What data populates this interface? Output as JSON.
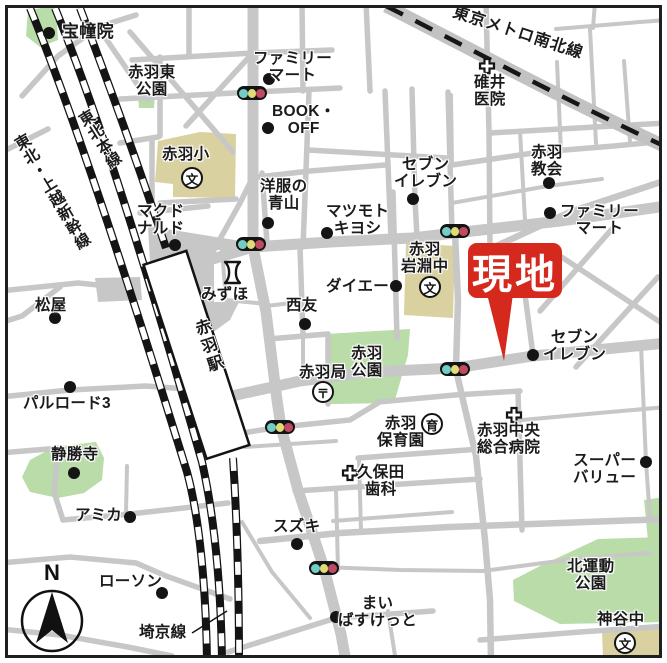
{
  "colors": {
    "road": "#c7c7c7",
    "park": "#b9dca8",
    "building": "#d9d1a0",
    "rail_black": "#141414",
    "target_red": "#d6291d",
    "text": "#1b1b1b",
    "signal_left": "#72cdc6",
    "signal_middle": "#dfdc76",
    "signal_right": "#c14a63"
  },
  "target": {
    "label": "現地"
  },
  "compass": {
    "label": "N"
  },
  "icons": {
    "school": "文",
    "post_office": "〒",
    "nursery": "育"
  },
  "railways": {
    "tohoku_honsen": "東北本線",
    "shinkansen": "東北・上越新幹線",
    "saikyo": "埼京線",
    "namboku": "東京メトロ南北線",
    "station": "赤羽駅"
  },
  "places": [
    {
      "id": "houdouin",
      "label": "宝幢院"
    },
    {
      "id": "akabane-higashi-park",
      "label": "赤羽東\n公園"
    },
    {
      "id": "familymart-north",
      "label": "ファミリー\nマート"
    },
    {
      "id": "book-off",
      "label": "BOOK・\nOFF"
    },
    {
      "id": "usui-clinic",
      "label": "碓井\n医院"
    },
    {
      "id": "akabane-elementary",
      "label": "赤羽小"
    },
    {
      "id": "seven-eleven-north",
      "label": "セブン\nイレブン"
    },
    {
      "id": "akabane-church",
      "label": "赤羽\n教会"
    },
    {
      "id": "yofuku-no-aoyama",
      "label": "洋服の\n青山"
    },
    {
      "id": "mcdonalds",
      "label": "マクド\nナルド"
    },
    {
      "id": "matsumoto-kiyoshi",
      "label": "マツモト\nキヨシ"
    },
    {
      "id": "familymart-east",
      "label": "ファミリー\nマート"
    },
    {
      "id": "akabane-iwabuchi-jhs",
      "label": "赤羽\n岩淵中"
    },
    {
      "id": "mizuho",
      "label": "みずほ"
    },
    {
      "id": "daiei",
      "label": "ダイエー"
    },
    {
      "id": "seiyu",
      "label": "西友"
    },
    {
      "id": "matsuya",
      "label": "松屋"
    },
    {
      "id": "akabane-park",
      "label": "赤羽\n公園"
    },
    {
      "id": "akabane-post-office",
      "label": "赤羽局"
    },
    {
      "id": "palroad3",
      "label": "パルロード3"
    },
    {
      "id": "seven-eleven-east",
      "label": "セブン\nイレブン"
    },
    {
      "id": "akabane-nursery",
      "label": "赤羽\n保育園"
    },
    {
      "id": "akabane-chuo-hospital",
      "label": "赤羽中央\n総合病院"
    },
    {
      "id": "super-value",
      "label": "スーパー\nバリュー"
    },
    {
      "id": "kubota-dental",
      "label": "久保田\n歯科"
    },
    {
      "id": "joshoji",
      "label": "静勝寺"
    },
    {
      "id": "amica",
      "label": "アミカ"
    },
    {
      "id": "lawson",
      "label": "ローソン"
    },
    {
      "id": "suzuki",
      "label": "スズキ"
    },
    {
      "id": "my-basket",
      "label": "まい\nばすけっと"
    },
    {
      "id": "kita-undo-park",
      "label": "北運動\n公園"
    },
    {
      "id": "kamiya-jhs",
      "label": "神谷中"
    }
  ]
}
